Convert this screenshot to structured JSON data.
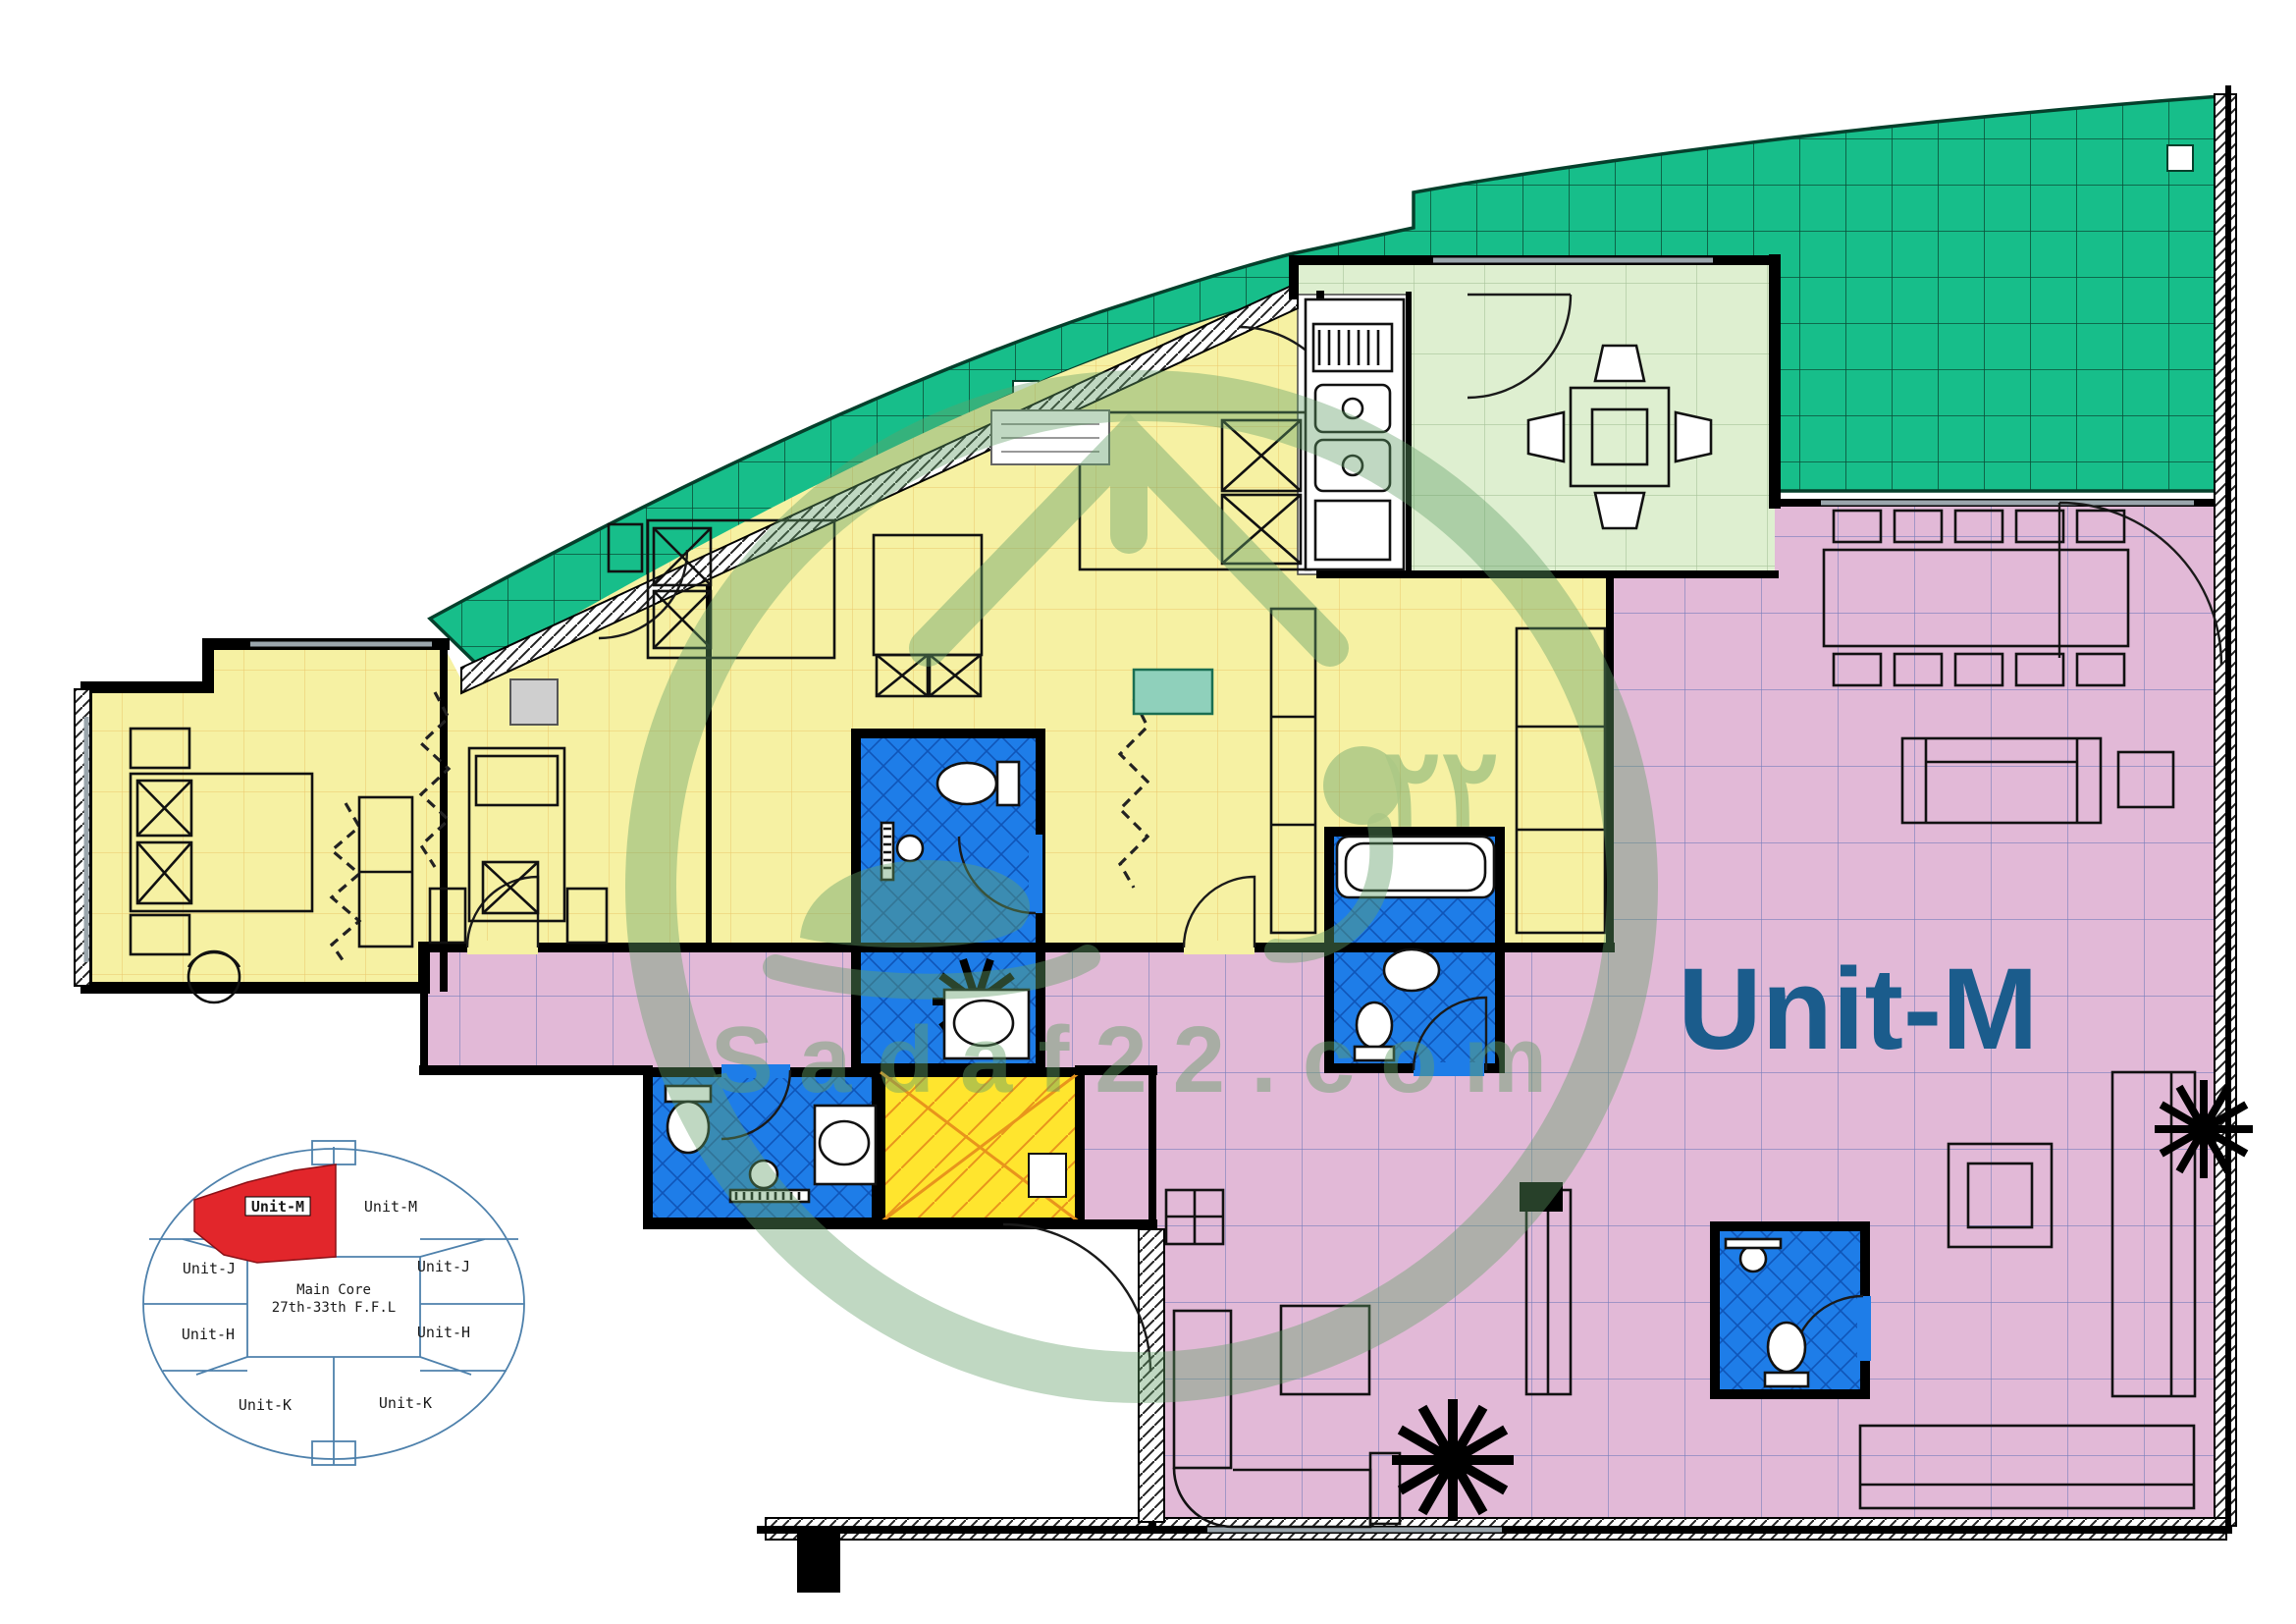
{
  "unit": {
    "label": "Unit-M"
  },
  "watermark": {
    "site": "Sadaf22.com",
    "number": "٢٢"
  },
  "key_plan": {
    "core_line1": "Main Core",
    "core_line2": "27th-33th F.F.L",
    "units": [
      {
        "label": "Unit-M",
        "highlighted": true
      },
      {
        "label": "Unit-M",
        "highlighted": false
      },
      {
        "label": "Unit-J",
        "highlighted": false
      },
      {
        "label": "Unit-J",
        "highlighted": false
      },
      {
        "label": "Unit-H",
        "highlighted": false
      },
      {
        "label": "Unit-H",
        "highlighted": false
      },
      {
        "label": "Unit-K",
        "highlighted": false
      },
      {
        "label": "Unit-K",
        "highlighted": false
      }
    ]
  },
  "colors": {
    "terrace": "#17BE8A",
    "terrace_line": "#0B4F38",
    "bedroom": "#F6F1A3",
    "bedroom_line": "#E2A23B",
    "kitchen": "#DEEFD0",
    "kitchen_line": "#A9C49A",
    "living": "#E2B9D7",
    "living_line": "#5C6FB4",
    "bath": "#1E7DE8",
    "bath_line": "#0F55B8",
    "shower": "#FFE52E",
    "shower_line": "#E8941C",
    "wall": "#000000",
    "window": "#9AA5AC",
    "unit_label": "#1B5C8C",
    "watermark": "#63A068",
    "keyplan_outline": "#4E81AC",
    "keyplan_highlight": "#E2262B",
    "furniture": "#111111"
  }
}
